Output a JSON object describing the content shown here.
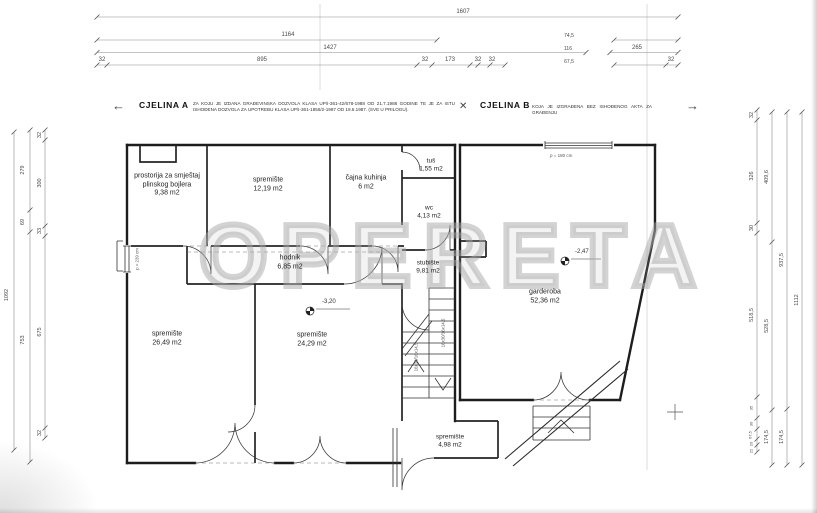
{
  "watermark": "OPERETA",
  "header": {
    "arrow_left": "←",
    "arrow_right": "→",
    "break_icon": "✕",
    "cjelina_a_title": "CJELINA A",
    "cjelina_a_note": "ZA KOJU JE IZDANA GRAĐEVINSKA DOZVOLA KLASA UP/I-361-42/678-1988 OD 21.7.1988 GODINE TE JE ZA ISTU ISHOĐENA DOZVOLA ZA UPOTREBU KLASA UP/I-361-1856/2-1987 OD 19.6.1987. (SVE U PRILOGU).",
    "cjelina_b_title": "CJELINA B",
    "cjelina_b_note": "KOJA JE IZGRAĐENA BEZ ISHOĐENOG AKTA ZA GRAĐENJU"
  },
  "rooms": [
    {
      "name": "prostorija za smještaj",
      "name2": "plinskog bojlera",
      "area": "9,38 m2"
    },
    {
      "name": "spremište",
      "area": "12,19 m2"
    },
    {
      "name": "čajna kuhinja",
      "area": "6 m2"
    },
    {
      "name": "tuš",
      "area": "1,55 m2"
    },
    {
      "name": "wc",
      "area": "4,13 m2"
    },
    {
      "name": "hodnik",
      "area": "6,85 m2"
    },
    {
      "name": "stubište",
      "area": "9,81 m2"
    },
    {
      "name": "spremište",
      "area": "26,49 m2"
    },
    {
      "name": "spremište",
      "area": "24,29 m2"
    },
    {
      "name": "garderoba",
      "area": "52,36 m2"
    },
    {
      "name": "spremište",
      "area": "4,98 m2"
    }
  ],
  "annotations": {
    "level_a": "-3,20",
    "level_b": "-2,47",
    "parapet_garderoba": "p = 180 cm",
    "parapet_left": "p = 239 cm",
    "stair_spec": "16x30/16x14,5"
  },
  "dims": {
    "top": [
      "1607",
      "1164",
      "1427",
      "32",
      "895",
      "32",
      "173",
      "32",
      "32",
      "74,5",
      "116",
      "67,5",
      "265",
      "32"
    ],
    "left": [
      "1092",
      "279",
      "69",
      "753",
      "32",
      "300",
      "33",
      "675",
      "32"
    ],
    "right": [
      "32",
      "326",
      "30",
      "518,5",
      "35",
      "30",
      "67,5",
      "20",
      "22",
      "409,6",
      "528,5",
      "174,5",
      "937,5",
      "174,5",
      "1112"
    ]
  }
}
